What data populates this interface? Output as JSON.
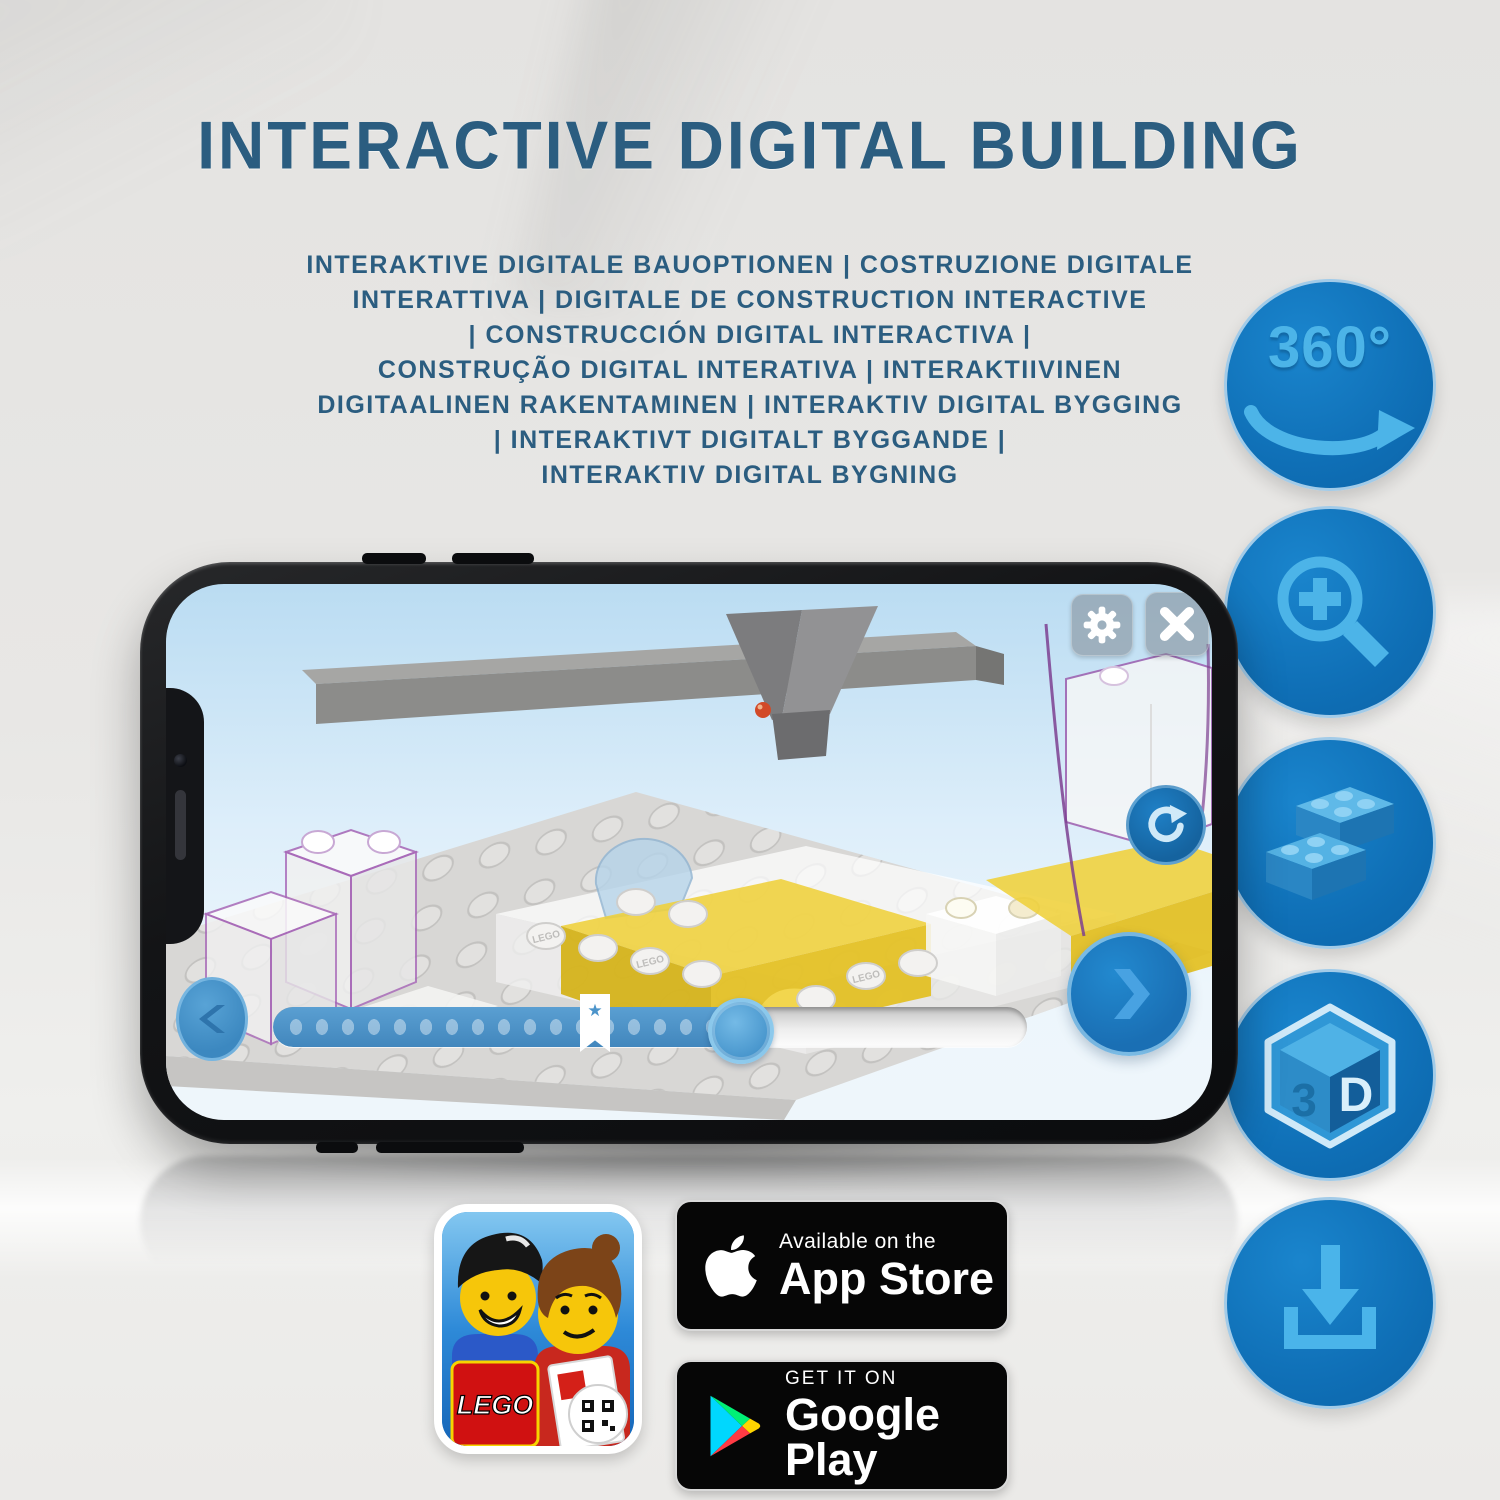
{
  "title": "INTERACTIVE DIGITAL BUILDING",
  "subtitle_lines": [
    "INTERAKTIVE DIGITALE BAUOPTIONEN | COSTRUZIONE DIGITALE",
    "INTERATTIVA | DIGITALE DE CONSTRUCTION INTERACTIVE",
    "| CONSTRUCCIÓN DIGITAL INTERACTIVA |",
    "CONSTRUÇÃO DIGITAL INTERATIVA | INTERAKTIIVINEN",
    "DIGITAALINEN RAKENTAMINEN | INTERAKTIV DIGITAL BYGGING",
    "| INTERAKTIVT DIGITALT BYGGANDE |",
    "INTERAKTIV DIGITAL BYGNING"
  ],
  "features": {
    "rotation_label": "360°",
    "cube_left": "3",
    "cube_right": "D"
  },
  "phone": {
    "stud_text": "LEGO",
    "slider": {
      "star_glyph": "★"
    }
  },
  "app_icon": {
    "logo_text": "LEGO"
  },
  "badges": {
    "app_store": {
      "line1": "Available on the",
      "line2": "App Store"
    },
    "google_play": {
      "line1": "GET IT ON",
      "line2": "Google Play"
    }
  },
  "colors": {
    "accent_blue": "#1478bf",
    "icon_light_blue": "#4cb4e8",
    "heading_blue": "#2b5d80",
    "brick_yellow": "#efd03a",
    "slider_blue": "#4c94ca"
  }
}
